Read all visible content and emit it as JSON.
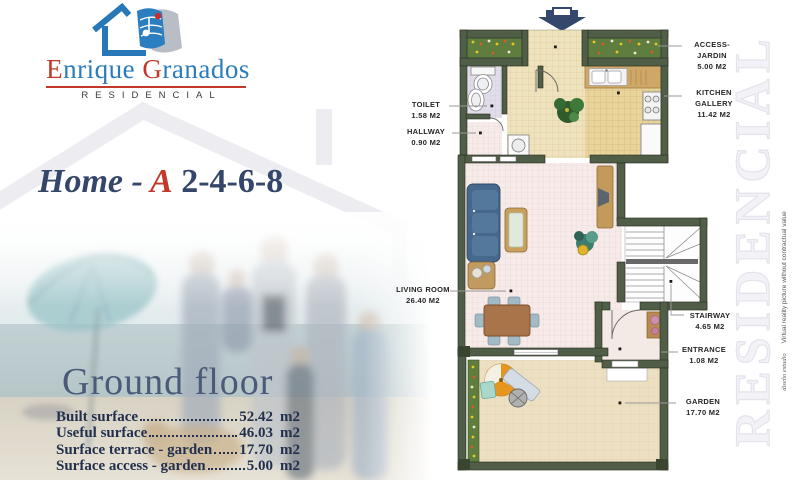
{
  "brand": {
    "initial1": "E",
    "rest1": "nrique ",
    "initial2": "G",
    "rest2": "ranados",
    "subtitle": "RESIDENCIAL"
  },
  "title": {
    "prefix": "Home - ",
    "variant": "A",
    "numbers": " 2-4-6-8"
  },
  "section": {
    "heading": "Ground floor",
    "rows": [
      {
        "label": "Built surface",
        "value": "52.42",
        "unit": "m2"
      },
      {
        "label": "Useful surface",
        "value": "46.03",
        "unit": "m2"
      },
      {
        "label": "Surface terrace - garden",
        "value": "17.70",
        "unit": "m2"
      },
      {
        "label": "Surface access - garden",
        "value": "5.00",
        "unit": "m2"
      }
    ]
  },
  "floorplan": {
    "labels": {
      "access": {
        "name": "ACCESS-JARDIN",
        "area": "5.00 M2"
      },
      "kitchen": {
        "name": "KITCHEN GALLERY",
        "area": "11.42 M2"
      },
      "toilet": {
        "name": "TOILET",
        "area": "1.58 M2"
      },
      "hallway": {
        "name": "HALLWAY",
        "area": "0.90 M2"
      },
      "living": {
        "name": "LIVING ROOM",
        "area": "26.40 M2"
      },
      "stairway": {
        "name": "STAIRWAY",
        "area": "4.65 M2"
      },
      "entrance": {
        "name": "ENTRANCE",
        "area": "1.08 M2"
      },
      "garden": {
        "name": "GARDEN",
        "area": "17.70 M2"
      }
    }
  },
  "watermark": {
    "text": "RESIDENCIAL"
  },
  "side_note": {
    "script": "diseño estudio",
    "text": "Virtual reality picture without contractual value"
  },
  "colors": {
    "brand_blue": "#2a7cba",
    "accent_red": "#c0392b",
    "navy_text": "#22304e",
    "wall_green": "#515e47"
  }
}
